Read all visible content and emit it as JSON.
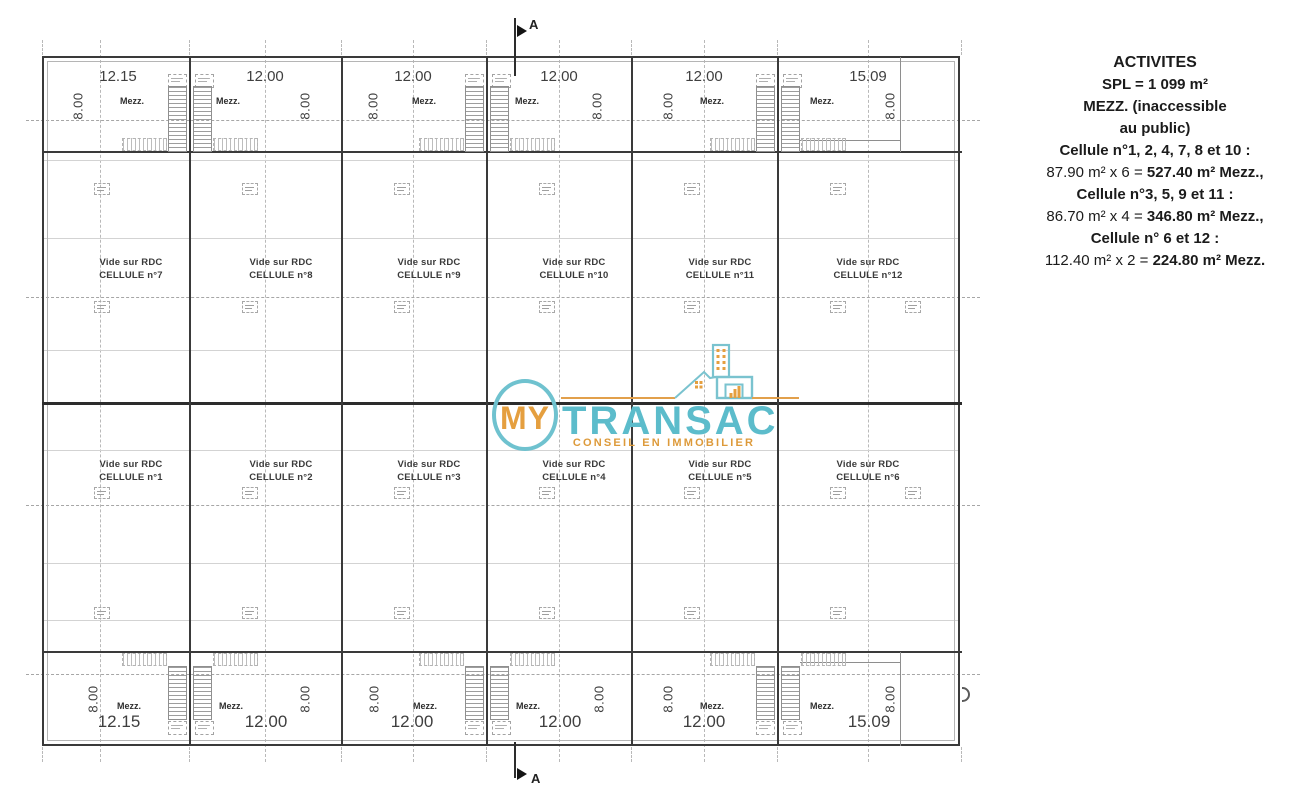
{
  "plan": {
    "section_label": "A",
    "vide_label": "Vide sur RDC",
    "mezz_label": "Mezz.",
    "depth_dim": "8.00",
    "top_dims": [
      "12.15",
      "12.00",
      "12.00",
      "12.00",
      "12.00",
      "15.09"
    ],
    "bottom_dims": [
      "12.15",
      "12.00",
      "12.00",
      "12.00",
      "12.00",
      "15.09"
    ],
    "upper_cell_names": [
      "CELLULE n°7",
      "CELLULE n°8",
      "CELLULE n°9",
      "CELLULE n°10",
      "CELLULE n°11",
      "CELLULE n°12"
    ],
    "lower_cell_names": [
      "CELLULE n°1",
      "CELLULE n°2",
      "CELLULE n°3",
      "CELLULE n°4",
      "CELLULE n°5",
      "CELLULE n°6"
    ]
  },
  "logo": {
    "monogram": "MY",
    "name": "TRANSAC",
    "tagline": "CONSEIL EN IMMOBILIER",
    "teal": "#5cbccb",
    "orange": "#e59f3f"
  },
  "legend": {
    "title": "ACTIVITES",
    "spl": "SPL =  1 099 m²",
    "mezz_line1": "MEZZ. (inaccessible",
    "mezz_line2": "au public)",
    "groups": [
      {
        "title": "Cellule n°1, 2, 4, 7, 8 et 10 :",
        "calc": "87.90 m² x 6 = ",
        "result": "527.40 m² Mezz.,"
      },
      {
        "title": "Cellule n°3, 5, 9 et 11 :",
        "calc": "86.70 m² x 4 = ",
        "result": "346.80 m² Mezz.,"
      },
      {
        "title": "Cellule n° 6 et 12 :",
        "calc": "112.40 m² x 2 = ",
        "result": "224.80 m² Mezz."
      }
    ]
  }
}
